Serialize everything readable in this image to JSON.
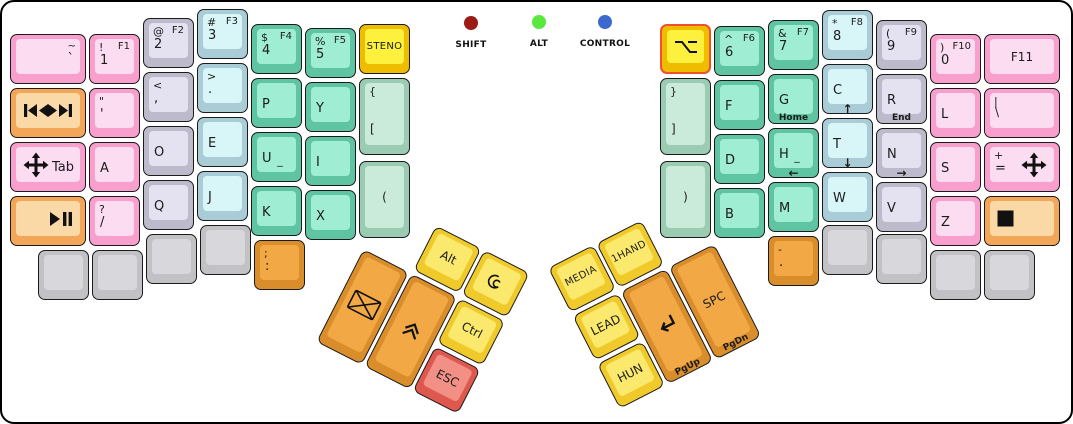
{
  "palette": {
    "pink": {
      "side": "#F99FCE",
      "face": "#FBDCF1"
    },
    "lavender": {
      "side": "#BDBACB",
      "face": "#E4E2F1"
    },
    "cyan": {
      "side": "#A9CCD6",
      "face": "#D8F6F8"
    },
    "teal": {
      "side": "#5FC4A2",
      "face": "#9FEDD2"
    },
    "sage": {
      "side": "#9BCBB2",
      "face": "#CBEBDA"
    },
    "yellow": {
      "side": "#EFBD00",
      "face": "#FDF13D"
    },
    "tyellow": {
      "side": "#F0CA2A",
      "face": "#FAE96C"
    },
    "orange": {
      "side": "#DA8E2B",
      "face": "#F2A945"
    },
    "peach": {
      "side": "#F3A558",
      "face": "#FAD9A7"
    },
    "red": {
      "side": "#DF584E",
      "face": "#F29086"
    },
    "gray": {
      "side": "#C2C2C6",
      "face": "#D8D8DC"
    },
    "highlight_border": "#F0502F"
  },
  "indicators": {
    "items": [
      {
        "label": "SHIFT",
        "color": "#9B1B15"
      },
      {
        "label": "ALT",
        "color": "#5BE83E"
      },
      {
        "label": "CONTROL",
        "color": "#3C69D0"
      }
    ]
  },
  "keys": [
    {
      "name": "key-tilde",
      "x": 8,
      "y": 32,
      "w": 76,
      "h": 50,
      "color": "pink",
      "legends": {
        "tr": "~",
        "mr": "`"
      }
    },
    {
      "name": "key-1",
      "x": 87,
      "y": 32,
      "w": 51,
      "h": 50,
      "color": "pink",
      "legends": {
        "tl": "!",
        "tr": "F1",
        "ml": "1"
      }
    },
    {
      "name": "key-2",
      "x": 141,
      "y": 16,
      "w": 51,
      "h": 50,
      "color": "lavender",
      "legends": {
        "tl": "@",
        "tr": "F2",
        "ml": "2"
      }
    },
    {
      "name": "key-3",
      "x": 195,
      "y": 7,
      "w": 51,
      "h": 50,
      "color": "cyan",
      "legends": {
        "tl": "#",
        "tr": "F3",
        "ml": "3"
      }
    },
    {
      "name": "key-4",
      "x": 249,
      "y": 22,
      "w": 51,
      "h": 50,
      "color": "teal",
      "legends": {
        "tl": "$",
        "tr": "F4",
        "ml": "4"
      }
    },
    {
      "name": "key-5",
      "x": 303,
      "y": 26,
      "w": 51,
      "h": 50,
      "color": "teal",
      "legends": {
        "tl": "%",
        "tr": "F5",
        "ml": "5"
      }
    },
    {
      "name": "key-steno",
      "x": 357,
      "y": 22,
      "w": 51,
      "h": 50,
      "color": "yellow",
      "legends": {
        "c": "STENO"
      }
    },
    {
      "name": "key-media-prev-next",
      "x": 8,
      "y": 86,
      "w": 76,
      "h": 50,
      "color": "peach",
      "icons": [
        {
          "n": "previous-track-icon",
          "pos": "l"
        },
        {
          "n": "next-track-icon",
          "pos": "r"
        }
      ]
    },
    {
      "name": "key-quote",
      "x": 87,
      "y": 86,
      "w": 51,
      "h": 50,
      "color": "pink",
      "legends": {
        "tl": "\"",
        "ml": "'"
      }
    },
    {
      "name": "key-comma",
      "x": 141,
      "y": 70,
      "w": 51,
      "h": 50,
      "color": "lavender",
      "legends": {
        "tl": "<",
        "ml": ","
      }
    },
    {
      "name": "key-period",
      "x": 195,
      "y": 61,
      "w": 51,
      "h": 50,
      "color": "cyan",
      "legends": {
        "tl": ">",
        "ml": "."
      }
    },
    {
      "name": "key-p",
      "x": 249,
      "y": 76,
      "w": 51,
      "h": 50,
      "color": "teal",
      "legends": {
        "ml": "P"
      }
    },
    {
      "name": "key-y",
      "x": 303,
      "y": 80,
      "w": 51,
      "h": 50,
      "color": "teal",
      "legends": {
        "ml": "Y"
      }
    },
    {
      "name": "key-brace-open",
      "x": 357,
      "y": 76,
      "w": 51,
      "h": 77,
      "color": "sage",
      "legends": {
        "tl": "{",
        "bl": "["
      }
    },
    {
      "name": "key-tab",
      "x": 8,
      "y": 140,
      "w": 76,
      "h": 50,
      "color": "pink",
      "legends": {
        "mr": "Tab"
      },
      "icons": [
        {
          "n": "move-icon",
          "pos": "l"
        }
      ]
    },
    {
      "name": "key-a",
      "x": 87,
      "y": 140,
      "w": 51,
      "h": 50,
      "color": "pink",
      "legends": {
        "ml": "A"
      }
    },
    {
      "name": "key-o",
      "x": 141,
      "y": 124,
      "w": 51,
      "h": 50,
      "color": "lavender",
      "legends": {
        "ml": "O"
      }
    },
    {
      "name": "key-e",
      "x": 195,
      "y": 115,
      "w": 51,
      "h": 50,
      "color": "cyan",
      "legends": {
        "ml": "E"
      }
    },
    {
      "name": "key-u",
      "x": 249,
      "y": 130,
      "w": 51,
      "h": 50,
      "color": "teal",
      "legends": {
        "ml": "U",
        "sub": "_"
      }
    },
    {
      "name": "key-i",
      "x": 303,
      "y": 134,
      "w": 51,
      "h": 50,
      "color": "teal",
      "legends": {
        "ml": "I"
      }
    },
    {
      "name": "key-paren-open",
      "x": 357,
      "y": 159,
      "w": 51,
      "h": 77,
      "color": "sage",
      "legends": {
        "c": "("
      }
    },
    {
      "name": "key-play-pause",
      "x": 8,
      "y": 194,
      "w": 76,
      "h": 50,
      "color": "peach",
      "icons": [
        {
          "n": "play-pause-icon",
          "pos": "r"
        }
      ]
    },
    {
      "name": "key-question-slash",
      "x": 87,
      "y": 194,
      "w": 51,
      "h": 50,
      "color": "pink",
      "legends": {
        "tl": "?",
        "ml": "/"
      }
    },
    {
      "name": "key-q",
      "x": 141,
      "y": 178,
      "w": 51,
      "h": 50,
      "color": "lavender",
      "legends": {
        "ml": "Q"
      }
    },
    {
      "name": "key-j",
      "x": 195,
      "y": 169,
      "w": 51,
      "h": 50,
      "color": "cyan",
      "legends": {
        "ml": "J"
      }
    },
    {
      "name": "key-k",
      "x": 249,
      "y": 184,
      "w": 51,
      "h": 50,
      "color": "teal",
      "legends": {
        "ml": "K"
      }
    },
    {
      "name": "key-x",
      "x": 303,
      "y": 188,
      "w": 51,
      "h": 50,
      "color": "teal",
      "legends": {
        "ml": "X"
      }
    },
    {
      "name": "key-blank-1",
      "x": 36,
      "y": 248,
      "w": 51,
      "h": 50,
      "color": "gray"
    },
    {
      "name": "key-blank-2",
      "x": 90,
      "y": 248,
      "w": 51,
      "h": 50,
      "color": "gray"
    },
    {
      "name": "key-blank-3",
      "x": 144,
      "y": 232,
      "w": 51,
      "h": 50,
      "color": "gray"
    },
    {
      "name": "key-blank-4",
      "x": 198,
      "y": 223,
      "w": 51,
      "h": 50,
      "color": "gray"
    },
    {
      "name": "key-semicolon",
      "x": 252,
      "y": 238,
      "w": 51,
      "h": 50,
      "color": "orange",
      "legends": {
        "tl": ";",
        "ml": ":"
      }
    },
    {
      "name": "key-option",
      "x": 658,
      "y": 22,
      "w": 51,
      "h": 50,
      "color": "yellow",
      "highlight": true,
      "icons": [
        {
          "n": "option-icon",
          "pos": "c"
        }
      ]
    },
    {
      "name": "key-6",
      "x": 712,
      "y": 24,
      "w": 51,
      "h": 50,
      "color": "teal",
      "legends": {
        "tl": "^",
        "tr": "F6",
        "ml": "6"
      }
    },
    {
      "name": "key-7",
      "x": 766,
      "y": 18,
      "w": 51,
      "h": 50,
      "color": "teal",
      "legends": {
        "tl": "&",
        "tr": "F7",
        "ml": "7"
      }
    },
    {
      "name": "key-8",
      "x": 820,
      "y": 8,
      "w": 51,
      "h": 50,
      "color": "cyan",
      "legends": {
        "tl": "*",
        "tr": "F8",
        "ml": "8"
      }
    },
    {
      "name": "key-9",
      "x": 874,
      "y": 18,
      "w": 51,
      "h": 50,
      "color": "lavender",
      "legends": {
        "tl": "(",
        "tr": "F9",
        "ml": "9"
      }
    },
    {
      "name": "key-0",
      "x": 928,
      "y": 32,
      "w": 51,
      "h": 50,
      "color": "pink",
      "legends": {
        "tl": ")",
        "tr": "F10",
        "ml": "0"
      }
    },
    {
      "name": "key-f11",
      "x": 982,
      "y": 32,
      "w": 76,
      "h": 50,
      "color": "pink",
      "legends": {
        "c": "F11"
      }
    },
    {
      "name": "key-brace-close",
      "x": 658,
      "y": 76,
      "w": 51,
      "h": 77,
      "color": "sage",
      "legends": {
        "tl": "}",
        "bl": "]"
      }
    },
    {
      "name": "key-f",
      "x": 712,
      "y": 78,
      "w": 51,
      "h": 50,
      "color": "teal",
      "legends": {
        "ml": "F"
      }
    },
    {
      "name": "key-g",
      "x": 766,
      "y": 72,
      "w": 51,
      "h": 50,
      "color": "teal",
      "legends": {
        "ml": "G",
        "bottom": "Home"
      }
    },
    {
      "name": "key-c",
      "x": 820,
      "y": 62,
      "w": 51,
      "h": 50,
      "color": "cyan",
      "legends": {
        "ml": "C",
        "bottom": "↑"
      }
    },
    {
      "name": "key-r",
      "x": 874,
      "y": 72,
      "w": 51,
      "h": 50,
      "color": "lavender",
      "legends": {
        "ml": "R",
        "bottom": "End"
      }
    },
    {
      "name": "key-l",
      "x": 928,
      "y": 86,
      "w": 51,
      "h": 50,
      "color": "pink",
      "legends": {
        "ml": "L"
      }
    },
    {
      "name": "key-pipe",
      "x": 982,
      "y": 86,
      "w": 76,
      "h": 50,
      "color": "pink",
      "legends": {
        "tl": "|",
        "bl": "\\"
      }
    },
    {
      "name": "key-paren-close",
      "x": 658,
      "y": 159,
      "w": 51,
      "h": 77,
      "color": "sage",
      "legends": {
        "c": ")"
      }
    },
    {
      "name": "key-d",
      "x": 712,
      "y": 132,
      "w": 51,
      "h": 50,
      "color": "teal",
      "legends": {
        "ml": "D"
      }
    },
    {
      "name": "key-h",
      "x": 766,
      "y": 126,
      "w": 51,
      "h": 50,
      "color": "teal",
      "legends": {
        "ml": "H",
        "sub": "_",
        "bottom": "←"
      }
    },
    {
      "name": "key-t",
      "x": 820,
      "y": 116,
      "w": 51,
      "h": 50,
      "color": "cyan",
      "legends": {
        "ml": "T",
        "bottom": "↓"
      }
    },
    {
      "name": "key-n",
      "x": 874,
      "y": 126,
      "w": 51,
      "h": 50,
      "color": "lavender",
      "legends": {
        "ml": "N",
        "bottom": "→"
      }
    },
    {
      "name": "key-s",
      "x": 928,
      "y": 140,
      "w": 51,
      "h": 50,
      "color": "pink",
      "legends": {
        "ml": "S"
      }
    },
    {
      "name": "key-plus",
      "x": 982,
      "y": 140,
      "w": 76,
      "h": 50,
      "color": "pink",
      "legends": {
        "tl": "+",
        "ml": "="
      },
      "icons": [
        {
          "n": "move-icon",
          "pos": "r"
        }
      ]
    },
    {
      "name": "key-b",
      "x": 712,
      "y": 186,
      "w": 51,
      "h": 50,
      "color": "teal",
      "legends": {
        "ml": "B"
      }
    },
    {
      "name": "key-m",
      "x": 766,
      "y": 180,
      "w": 51,
      "h": 50,
      "color": "teal",
      "legends": {
        "ml": "M"
      }
    },
    {
      "name": "key-w",
      "x": 820,
      "y": 170,
      "w": 51,
      "h": 50,
      "color": "cyan",
      "legends": {
        "ml": "W"
      }
    },
    {
      "name": "key-v",
      "x": 874,
      "y": 180,
      "w": 51,
      "h": 50,
      "color": "lavender",
      "legends": {
        "ml": "V"
      }
    },
    {
      "name": "key-z",
      "x": 928,
      "y": 194,
      "w": 51,
      "h": 50,
      "color": "pink",
      "legends": {
        "ml": "Z"
      }
    },
    {
      "name": "key-stop",
      "x": 982,
      "y": 194,
      "w": 76,
      "h": 50,
      "color": "peach",
      "icons": [
        {
          "n": "stop-icon",
          "pos": "l"
        }
      ]
    },
    {
      "name": "key-minus",
      "x": 766,
      "y": 234,
      "w": 51,
      "h": 50,
      "color": "orange",
      "legends": {
        "tl": "-",
        "ml": "."
      }
    },
    {
      "name": "key-blank-5",
      "x": 820,
      "y": 223,
      "w": 51,
      "h": 50,
      "color": "gray"
    },
    {
      "name": "key-blank-6",
      "x": 874,
      "y": 232,
      "w": 51,
      "h": 50,
      "color": "gray"
    },
    {
      "name": "key-blank-7",
      "x": 928,
      "y": 248,
      "w": 51,
      "h": 50,
      "color": "gray"
    },
    {
      "name": "key-blank-8",
      "x": 982,
      "y": 248,
      "w": 51,
      "h": 50,
      "color": "gray"
    }
  ],
  "thumb_clusters": {
    "left": {
      "x": 386,
      "y": 199,
      "angle": 27,
      "keys": [
        {
          "name": "key-alt",
          "x": 54,
          "y": 0,
          "w": 51,
          "h": 50,
          "color": "tyellow",
          "legends": {
            "c": "Alt"
          }
        },
        {
          "name": "key-super",
          "x": 108,
          "y": 0,
          "w": 51,
          "h": 50,
          "color": "tyellow",
          "icons": [
            {
              "n": "debian-swirl-icon",
              "pos": "c"
            }
          ]
        },
        {
          "name": "key-mail",
          "x": 0,
          "y": 54,
          "w": 51,
          "h": 104,
          "color": "orange",
          "icons": [
            {
              "n": "envelope-icon",
              "pos": "c"
            }
          ]
        },
        {
          "name": "key-chevron",
          "x": 54,
          "y": 54,
          "w": 51,
          "h": 104,
          "color": "orange",
          "icons": [
            {
              "n": "double-chevron-up-icon",
              "pos": "c"
            }
          ]
        },
        {
          "name": "key-ctrl",
          "x": 108,
          "y": 54,
          "w": 51,
          "h": 50,
          "color": "tyellow",
          "legends": {
            "c": "Ctrl"
          }
        },
        {
          "name": "key-esc",
          "x": 108,
          "y": 108,
          "w": 51,
          "h": 50,
          "color": "red",
          "legends": {
            "c": "ESC"
          }
        }
      ]
    },
    "right": {
      "x": 546,
      "y": 266,
      "angle": -27,
      "keys": [
        {
          "name": "key-media-layer",
          "x": 0,
          "y": 0,
          "w": 51,
          "h": 50,
          "color": "tyellow",
          "legends": {
            "c": "MEDIA"
          }
        },
        {
          "name": "key-onehand-layer",
          "x": 54,
          "y": 0,
          "w": 51,
          "h": 50,
          "color": "tyellow",
          "legends": {
            "c": "1HAND"
          }
        },
        {
          "name": "key-lead",
          "x": 0,
          "y": 54,
          "w": 51,
          "h": 50,
          "color": "tyellow",
          "legends": {
            "c": "LEAD"
          }
        },
        {
          "name": "key-hun",
          "x": 0,
          "y": 108,
          "w": 51,
          "h": 50,
          "color": "tyellow",
          "legends": {
            "c": "HUN"
          }
        },
        {
          "name": "key-enter",
          "x": 54,
          "y": 54,
          "w": 51,
          "h": 104,
          "color": "orange",
          "legends": {
            "bottom": "PgUp"
          },
          "icons": [
            {
              "n": "enter-icon",
              "pos": "c"
            }
          ]
        },
        {
          "name": "key-space",
          "x": 108,
          "y": 54,
          "w": 51,
          "h": 104,
          "color": "orange",
          "legends": {
            "c": "SPC",
            "bottom": "PgDn"
          }
        }
      ]
    }
  }
}
